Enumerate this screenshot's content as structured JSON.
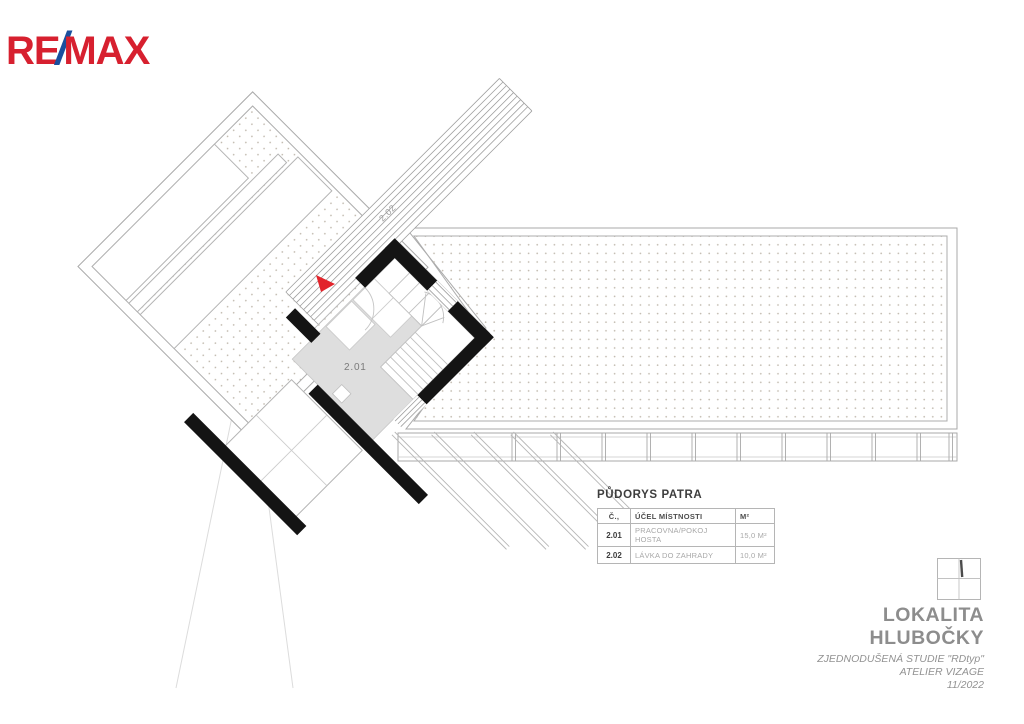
{
  "brand": {
    "re": "RE",
    "slash": "/",
    "max": "MAX"
  },
  "plan": {
    "room1_label": "2.01",
    "room2_label": "2.02"
  },
  "legend": {
    "title": "PŮDORYS PATRA",
    "col_no": "Č.,",
    "col_purpose": "ÚČEL MÍSTNOSTI",
    "col_area": "M²",
    "rows": [
      {
        "no": "2.01",
        "purpose": "PRACOVNA/POKOJ HOSTA",
        "area": "15,0 M²"
      },
      {
        "no": "2.02",
        "purpose": "LÁVKA DO ZAHRADY",
        "area": "10,0 M²"
      }
    ]
  },
  "titleblock": {
    "location1": "LOKALITA",
    "location2": "HLUBOČKY",
    "study": "ZJEDNODUŠENÁ STUDIE \"RDtyp\"",
    "studio": "ATELIER VIZAGE",
    "date": "11/2022"
  },
  "colors": {
    "brand_red": "#d7202f",
    "brand_blue": "#1a4f9e",
    "arrow_red": "#e2242b",
    "wall_black": "#141414",
    "floor_gray": "#dedede",
    "hatch_dot": "#c2bbb0"
  }
}
